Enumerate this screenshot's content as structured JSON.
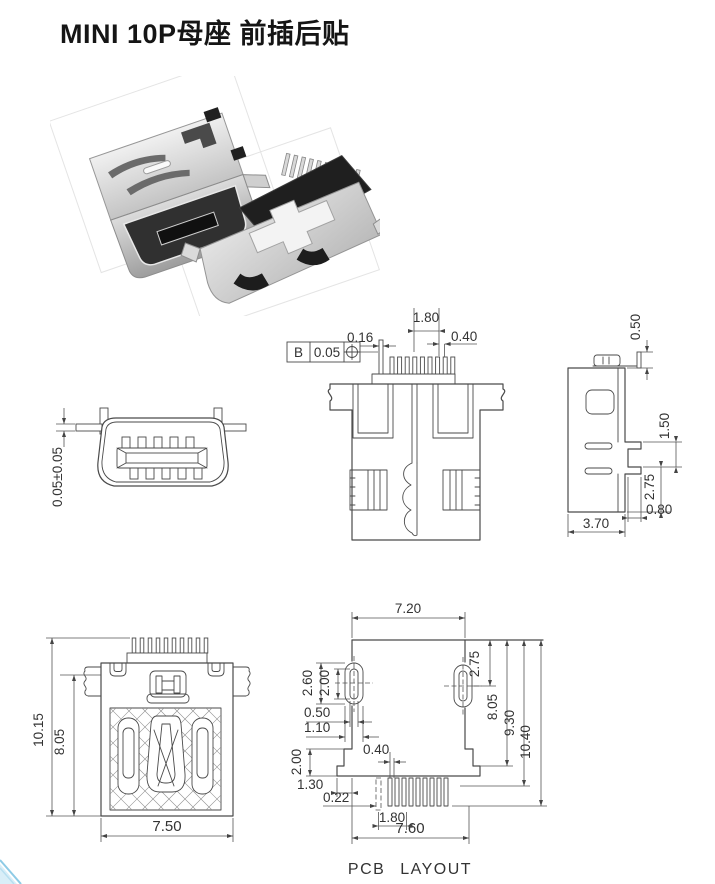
{
  "title": "MINI 10P母座 前插后贴",
  "footer_caption": "PCB LAYOUT",
  "front_view": {
    "seating_offset": "0.05±0.05"
  },
  "bottom_view": {
    "group_pitch": "1.80",
    "pin_thickness": "0.16",
    "pad_width": "0.40",
    "fcf": {
      "datum": "B",
      "tolerance": "0.05"
    }
  },
  "side_view": {
    "tab_height": "0.50",
    "leg_pitch": "1.50",
    "leg_span": "2.75",
    "leg_offset": "0.80",
    "body_depth": "3.70"
  },
  "top_view": {
    "overall_length": "10.15",
    "body_length": "8.05",
    "body_width": "7.50"
  },
  "pcb_layout": {
    "slot_span": "7.20",
    "slot_offset_right": "2.75",
    "slot_height": "2.60",
    "slot_inner_height": "2.00",
    "slot_inner_width": "0.50",
    "slot_width": "1.10",
    "depth_slot": "8.05",
    "depth_outline": "9.30",
    "depth_total": "10.40",
    "pad_width": "0.40",
    "step_height": "2.00",
    "step_width": "1.30",
    "holddown_width": "0.22",
    "pad_group_pitch": "1.80",
    "outline_width": "7.60"
  }
}
